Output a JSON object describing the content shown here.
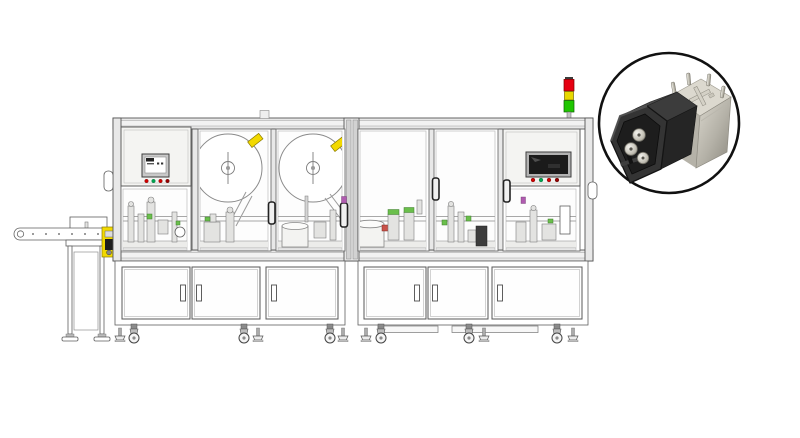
{
  "title": "Automatic assembly machine line drawing with connector product inset",
  "colors": {
    "background": "#ffffff",
    "outline": "#555555",
    "frame-fill": "#e8e8e8",
    "frame-light": "#f2f2f2",
    "glass": "#fdfdfd",
    "panel-fill": "#f4f4f2",
    "machinery": "#e3e3e1",
    "accent-yellow": "#f2d900",
    "accent-green": "#6abf4b",
    "accent-red": "#c9524a",
    "accent-magenta": "#b05bb0",
    "signal-red": "#e60012",
    "signal-yellow": "#e8d800",
    "signal-green": "#1fc600",
    "btn-red": "#d40000",
    "btn-green": "#00a651",
    "btn-darkred": "#990000",
    "screen-dark": "#1b1b1b",
    "inset-ring": "#111111",
    "connector-black": "#343434",
    "connector-metal": "#c9c6bc"
  },
  "machine": {
    "kind": "CAD line drawing of an automated assembly line",
    "modules": 2,
    "reels": 2,
    "signal_tower_lights": [
      "red",
      "yellow",
      "green"
    ],
    "left_hmi": {
      "screen": "light",
      "buttons": [
        "red",
        "green",
        "red",
        "dark-red"
      ]
    },
    "right_hmi": {
      "screen": "dark",
      "buttons": [
        "red",
        "green",
        "red",
        "dark-red"
      ]
    },
    "glass_doors": 6,
    "cabinet_doors": 6,
    "outfeed_conveyor": true
  },
  "inset": {
    "shape": "circle",
    "subject": "black connector housing with round metal contacts and plated metal shell pins"
  }
}
